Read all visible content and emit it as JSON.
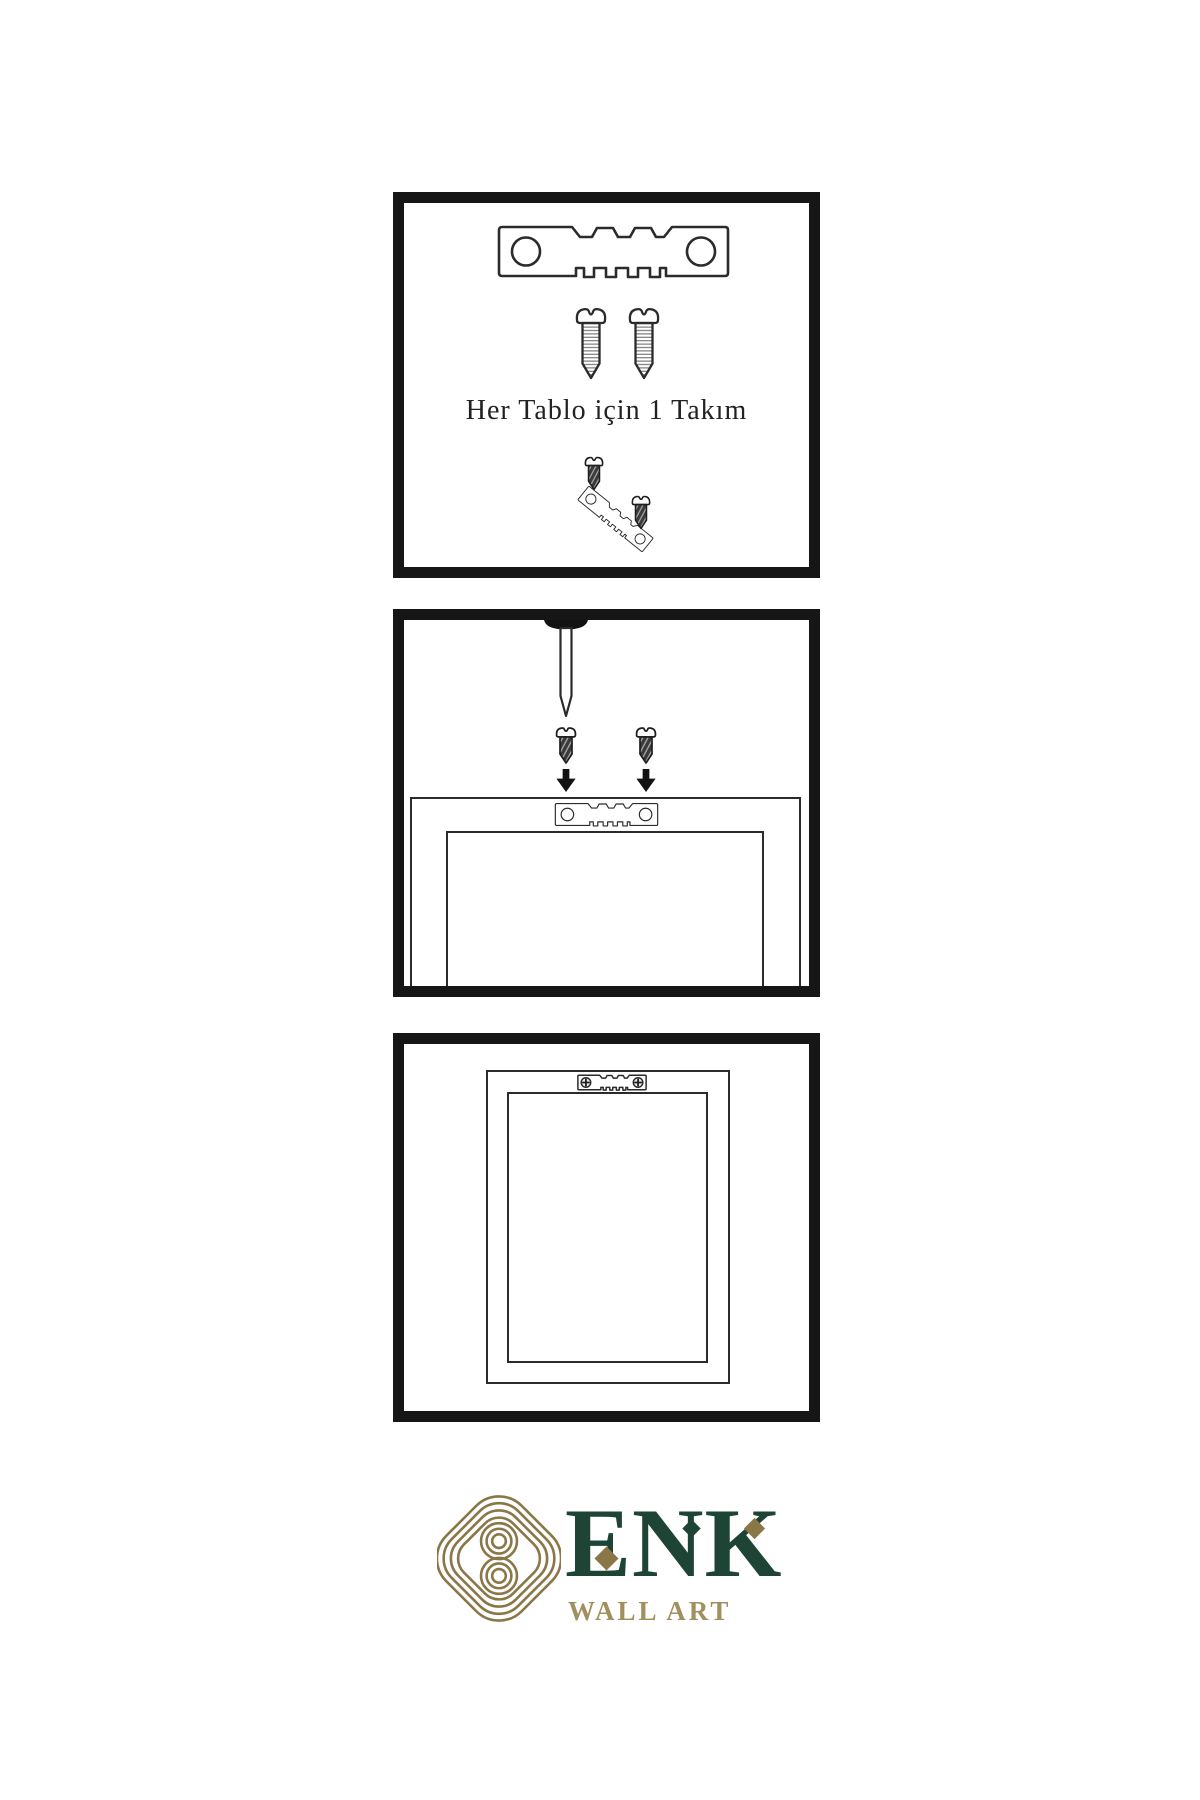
{
  "page": {
    "width": 1200,
    "height": 1800,
    "background": "#ffffff"
  },
  "colors": {
    "line_art": "#2b2b2b",
    "panel_border": "#161616",
    "dark_screw_fill": "#3a3a3a",
    "logo_knot_gold": "#8b7648",
    "logo_brand_green": "#1d4434",
    "logo_wordmark_gold": "#a28f5e"
  },
  "instructions": {
    "step1": {
      "caption": "Her Tablo için 1 Takım",
      "items": [
        "sawtooth-hanger",
        "screw",
        "screw",
        "small-screw",
        "angled-sawtooth-hanger",
        "small-screw"
      ]
    },
    "step2": {
      "items": [
        "wall-nail",
        "dark-screw",
        "dark-screw",
        "down-arrow",
        "down-arrow",
        "frame-back-with-sawtooth-hanger"
      ]
    },
    "step3": {
      "items": [
        "frame-back-with-mounted-hanger-and-screws"
      ]
    }
  },
  "logo": {
    "brand": "ENK",
    "subtitle": "WALL ART"
  }
}
